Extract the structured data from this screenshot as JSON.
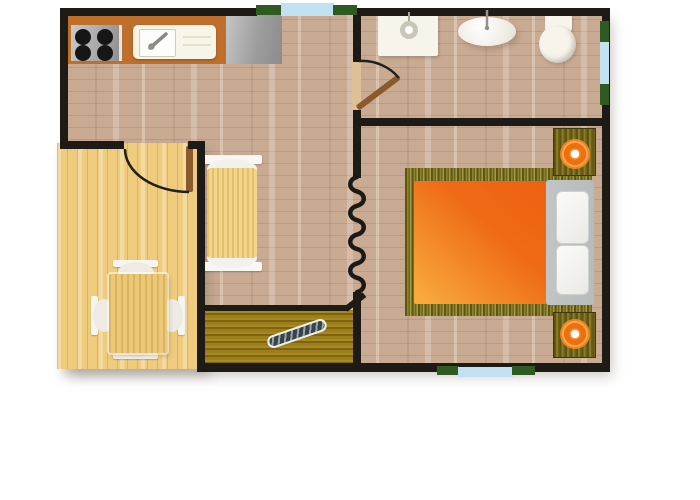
{
  "meta": {
    "type": "floor-plan",
    "view": "top-down",
    "description": "one-bedroom apartment floor plan with terrace"
  },
  "rooms": [
    {
      "name": "kitchen-living-area",
      "fixtures": [
        "stove-with-four-burners",
        "kitchen-sink-unit",
        "steel-countertop",
        "sofa"
      ]
    },
    {
      "name": "bathroom",
      "fixtures": [
        "shower-tray",
        "washbasin",
        "toilet"
      ]
    },
    {
      "name": "bedroom",
      "fixtures": [
        "double-bed-orange",
        "headboard-with-two-pillows",
        "nightstand-with-lamp-top",
        "nightstand-with-lamp-bottom"
      ]
    },
    {
      "name": "dining-terrace",
      "fixtures": [
        "dining-table",
        "chair-top",
        "chair-bottom",
        "chair-left",
        "chair-right"
      ]
    },
    {
      "name": "entryway",
      "fixtures": [
        "doormat",
        "shoe-scraper"
      ]
    }
  ],
  "openings": {
    "doors": [
      "bathroom-door",
      "terrace-door"
    ],
    "windows": [
      "top-window",
      "right-window",
      "bottom-window"
    ],
    "partition": "zigzag-wall-symbol"
  },
  "colors": {
    "background": "#ffffff",
    "wall": "#1e1b17",
    "floor_wood": "#c9ab94",
    "terrace_wood": "#efcb7e",
    "counter_wood": "#bd6f2b",
    "appliance_cream": "#f7f4e8",
    "burner_black": "#161616",
    "mat_gold": "#9c7f1c",
    "mat_gold_dark": "#7d6413",
    "bed_orange": "#ee6212",
    "bed_orange_light": "#f8a93c",
    "headboard_gray": "#b7bbbc",
    "lamp_orange": "#ed6f10",
    "lamp_orange_light": "#f6a747",
    "window_glass": "#c2e2f1",
    "window_shutter": "#2f5a22",
    "door_wood": "#8a5a2c",
    "door_jamb": "#ddc096",
    "fixture_white": "#f7f4ec",
    "sofa_yellow": "#f3d68c",
    "table_wood": "#ecc979",
    "scraper_dark": "#39424a",
    "scraper_light": "#93a4ac"
  }
}
